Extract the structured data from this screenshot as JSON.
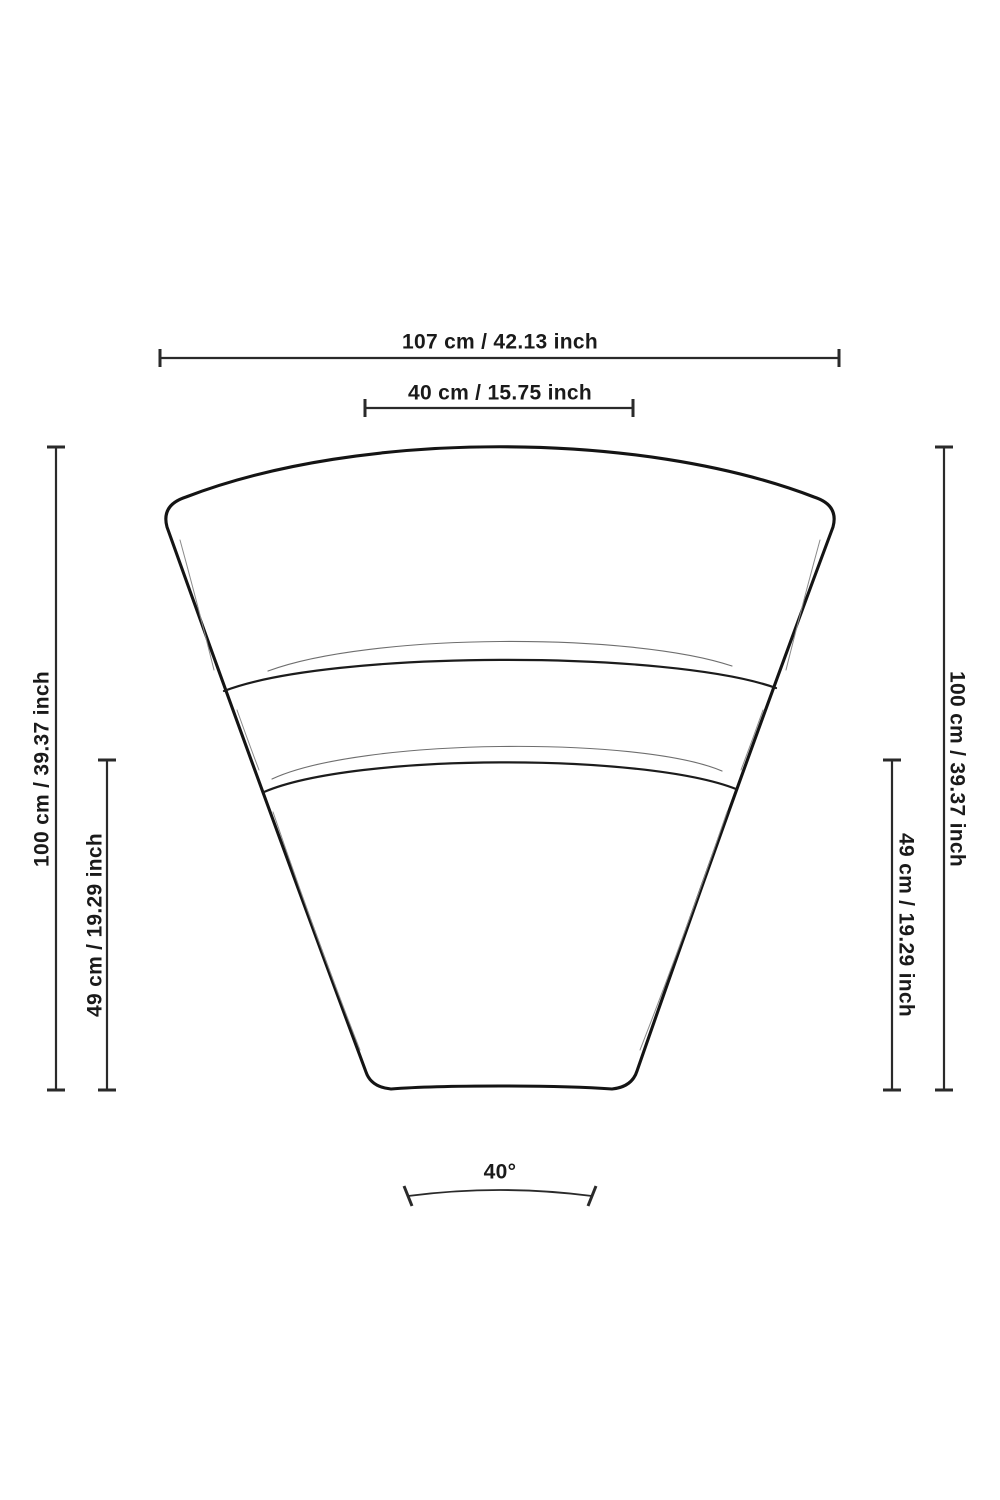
{
  "diagram": {
    "type": "furniture-dimension-drawing",
    "subject": "curved-sofa-segment-front-view",
    "colors": {
      "background": "#ffffff",
      "outline_ink": "#141414",
      "dimension_ink": "#2a2a2a",
      "text_ink": "#1a1a1a",
      "shading_ink": "#6e6e6e"
    },
    "dimensions": {
      "top_outer": {
        "label": "107 cm / 42.13 inch"
      },
      "top_inner": {
        "label": "40 cm / 15.75 inch"
      },
      "left_outer": {
        "label": "100 cm / 39.37 inch"
      },
      "left_inner": {
        "label": "49 cm / 19.29 inch"
      },
      "right_outer": {
        "label": "100 cm / 39.37 inch"
      },
      "right_inner": {
        "label": "49 cm / 19.29 inch"
      },
      "angle": {
        "label": "40°"
      }
    }
  }
}
